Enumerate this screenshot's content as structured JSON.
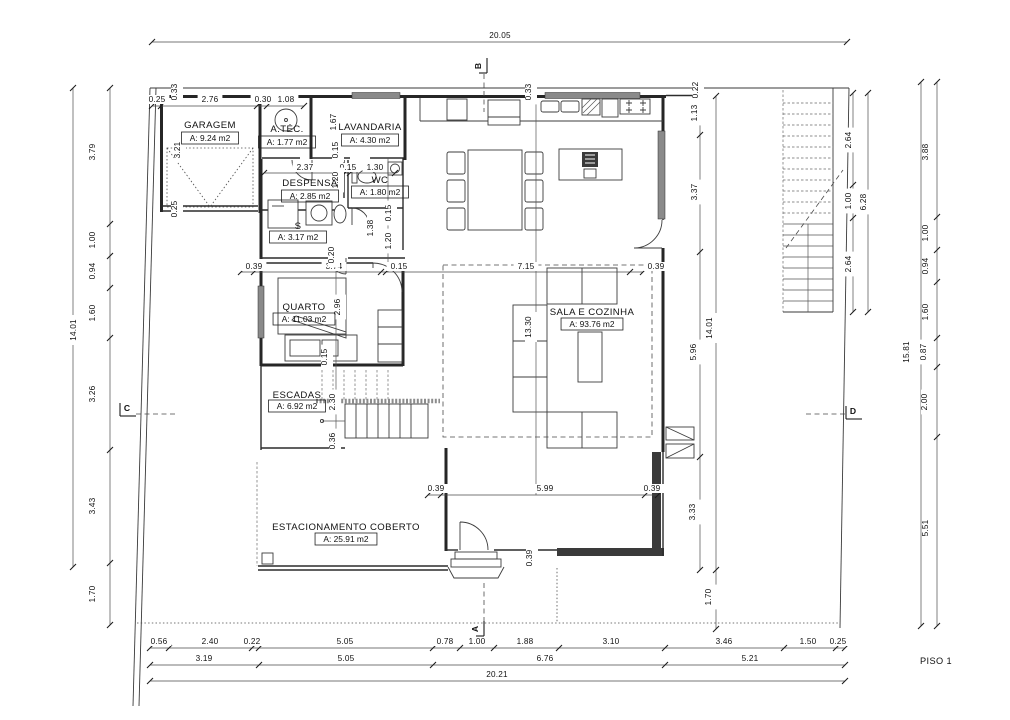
{
  "floor_plan": {
    "floor_label": "PISO 1",
    "rooms": [
      {
        "name": "GARAGEM",
        "area": "A: 9.24 m2",
        "x": 210,
        "y": 128,
        "ay": 141
      },
      {
        "name": "A.TÉC.",
        "area": "A: 1.77 m2",
        "x": 287,
        "y": 132,
        "ay": 145
      },
      {
        "name": "LAVANDARIA",
        "area": "A: 4.30 m2",
        "x": 370,
        "y": 130,
        "ay": 143
      },
      {
        "name": "DESPENSA",
        "area": "A: 2.85 m2",
        "x": 310,
        "y": 186,
        "ay": 199
      },
      {
        "name": "WC",
        "area": "A: 1.80 m2",
        "x": 380,
        "y": 183,
        "ay": 195
      },
      {
        "name": "S",
        "area": "A: 3.17 m2",
        "x": 298,
        "y": 229,
        "ay": 240
      },
      {
        "name": "QUARTO",
        "area": "A: 11.03 m2",
        "x": 304,
        "y": 310,
        "ay": 322
      },
      {
        "name": "ESCADAS",
        "area": "A: 6.92 m2",
        "x": 297,
        "y": 398,
        "ay": 409
      },
      {
        "name": "SALA E COZINHA",
        "area": "A: 93.76 m2",
        "x": 592,
        "y": 315,
        "ay": 327
      },
      {
        "name": "ESTACIONAMENTO COBERTO",
        "area": "A: 25.91 m2",
        "x": 346,
        "y": 530,
        "ay": 542
      }
    ],
    "dimensions": [
      {
        "t": "20.05",
        "x": 500,
        "y": 38
      },
      {
        "t": "0.33",
        "x": 177,
        "y": 92,
        "v": 1
      },
      {
        "t": "0.25",
        "x": 157,
        "y": 102
      },
      {
        "t": "2.76",
        "x": 210,
        "y": 102
      },
      {
        "t": "0.30",
        "x": 263,
        "y": 102
      },
      {
        "t": "1.08",
        "x": 286,
        "y": 102
      },
      {
        "t": "3.21",
        "x": 180,
        "y": 150,
        "v": 1
      },
      {
        "t": "0.25",
        "x": 177,
        "y": 209,
        "v": 1
      },
      {
        "t": "1.67",
        "x": 336,
        "y": 122,
        "v": 1
      },
      {
        "t": "0.33",
        "x": 531,
        "y": 92,
        "v": 1
      },
      {
        "t": "0.22",
        "x": 698,
        "y": 90,
        "v": 1
      },
      {
        "t": "1.13",
        "x": 697,
        "y": 113,
        "v": 1
      },
      {
        "t": "3.37",
        "x": 697,
        "y": 192,
        "v": 1
      },
      {
        "t": "5.96",
        "x": 696,
        "y": 352,
        "v": 1
      },
      {
        "t": "14.01",
        "x": 712,
        "y": 328,
        "v": 1
      },
      {
        "t": "3.33",
        "x": 695,
        "y": 512,
        "v": 1
      },
      {
        "t": "1.70",
        "x": 711,
        "y": 597,
        "v": 1
      },
      {
        "t": "2.37",
        "x": 305,
        "y": 170
      },
      {
        "t": "0.15",
        "x": 348,
        "y": 170
      },
      {
        "t": "1.30",
        "x": 375,
        "y": 170
      },
      {
        "t": "0.15",
        "x": 338,
        "y": 150,
        "v": 1
      },
      {
        "t": "1.20",
        "x": 338,
        "y": 180,
        "v": 1
      },
      {
        "t": "0.15",
        "x": 391,
        "y": 213,
        "v": 1
      },
      {
        "t": "1.20",
        "x": 391,
        "y": 241,
        "v": 1
      },
      {
        "t": "1.38",
        "x": 373,
        "y": 228,
        "v": 1
      },
      {
        "t": "0.20",
        "x": 339,
        "y": 257,
        "v": 1
      },
      {
        "t": "0.39",
        "x": 254,
        "y": 269
      },
      {
        "t": "3.74",
        "x": 334,
        "y": 269
      },
      {
        "t": "0.15",
        "x": 399,
        "y": 269
      },
      {
        "t": "7.15",
        "x": 526,
        "y": 269
      },
      {
        "t": "0.39",
        "x": 656,
        "y": 269
      },
      {
        "t": "0.20",
        "x": 334,
        "y": 255,
        "v": 1
      },
      {
        "t": "2.96",
        "x": 340,
        "y": 307,
        "v": 1
      },
      {
        "t": "0.15",
        "x": 327,
        "y": 357,
        "v": 1
      },
      {
        "t": "2.30",
        "x": 335,
        "y": 402,
        "v": 1
      },
      {
        "t": "0.36",
        "x": 335,
        "y": 441,
        "v": 1
      },
      {
        "t": "13.30",
        "x": 531,
        "y": 327,
        "v": 1
      },
      {
        "t": "0.39",
        "x": 436,
        "y": 491
      },
      {
        "t": "5.99",
        "x": 545,
        "y": 491
      },
      {
        "t": "0.39",
        "x": 652,
        "y": 491
      },
      {
        "t": "0.39",
        "x": 532,
        "y": 558,
        "v": 1
      },
      {
        "t": "3.79",
        "x": 95,
        "y": 152,
        "v": 1
      },
      {
        "t": "1.00",
        "x": 95,
        "y": 240,
        "v": 1
      },
      {
        "t": "0.94",
        "x": 95,
        "y": 271,
        "v": 1
      },
      {
        "t": "1.60",
        "x": 95,
        "y": 313,
        "v": 1
      },
      {
        "t": "3.26",
        "x": 95,
        "y": 394,
        "v": 1
      },
      {
        "t": "3.43",
        "x": 95,
        "y": 506,
        "v": 1
      },
      {
        "t": "1.70",
        "x": 95,
        "y": 594,
        "v": 1
      },
      {
        "t": "14.01",
        "x": 76,
        "y": 330,
        "v": 1
      },
      {
        "t": "2.64",
        "x": 851,
        "y": 140,
        "v": 1
      },
      {
        "t": "1.00",
        "x": 851,
        "y": 201,
        "v": 1
      },
      {
        "t": "2.64",
        "x": 851,
        "y": 264,
        "v": 1
      },
      {
        "t": "6.28",
        "x": 866,
        "y": 202,
        "v": 1
      },
      {
        "t": "3.88",
        "x": 928,
        "y": 152,
        "v": 1
      },
      {
        "t": "1.00",
        "x": 928,
        "y": 233,
        "v": 1
      },
      {
        "t": "0.94",
        "x": 928,
        "y": 266,
        "v": 1
      },
      {
        "t": "1.60",
        "x": 928,
        "y": 312,
        "v": 1
      },
      {
        "t": "0.87",
        "x": 926,
        "y": 352,
        "v": 1
      },
      {
        "t": "2.00",
        "x": 927,
        "y": 402,
        "v": 1
      },
      {
        "t": "5.51",
        "x": 928,
        "y": 528,
        "v": 1
      },
      {
        "t": "15.81",
        "x": 909,
        "y": 352,
        "v": 1
      },
      {
        "t": "0.56",
        "x": 159,
        "y": 644
      },
      {
        "t": "2.40",
        "x": 210,
        "y": 644
      },
      {
        "t": "0.22",
        "x": 252,
        "y": 644
      },
      {
        "t": "5.05",
        "x": 345,
        "y": 644
      },
      {
        "t": "0.78",
        "x": 445,
        "y": 644
      },
      {
        "t": "1.00",
        "x": 477,
        "y": 644
      },
      {
        "t": "1.88",
        "x": 525,
        "y": 644
      },
      {
        "t": "3.10",
        "x": 611,
        "y": 644
      },
      {
        "t": "3.46",
        "x": 724,
        "y": 644
      },
      {
        "t": "1.50",
        "x": 808,
        "y": 644
      },
      {
        "t": "0.25",
        "x": 838,
        "y": 644
      },
      {
        "t": "3.19",
        "x": 204,
        "y": 661
      },
      {
        "t": "5.05",
        "x": 346,
        "y": 661
      },
      {
        "t": "6.76",
        "x": 545,
        "y": 661
      },
      {
        "t": "5.21",
        "x": 750,
        "y": 661
      },
      {
        "t": "20.21",
        "x": 497,
        "y": 677
      }
    ],
    "section_markers": [
      {
        "label": "B",
        "x": 481,
        "y": 66,
        "v": 1
      },
      {
        "label": "A",
        "x": 478,
        "y": 629,
        "v": 1
      },
      {
        "label": "C",
        "x": 127,
        "y": 411,
        "v": 0
      },
      {
        "label": "D",
        "x": 853,
        "y": 414,
        "v": 0
      }
    ]
  }
}
